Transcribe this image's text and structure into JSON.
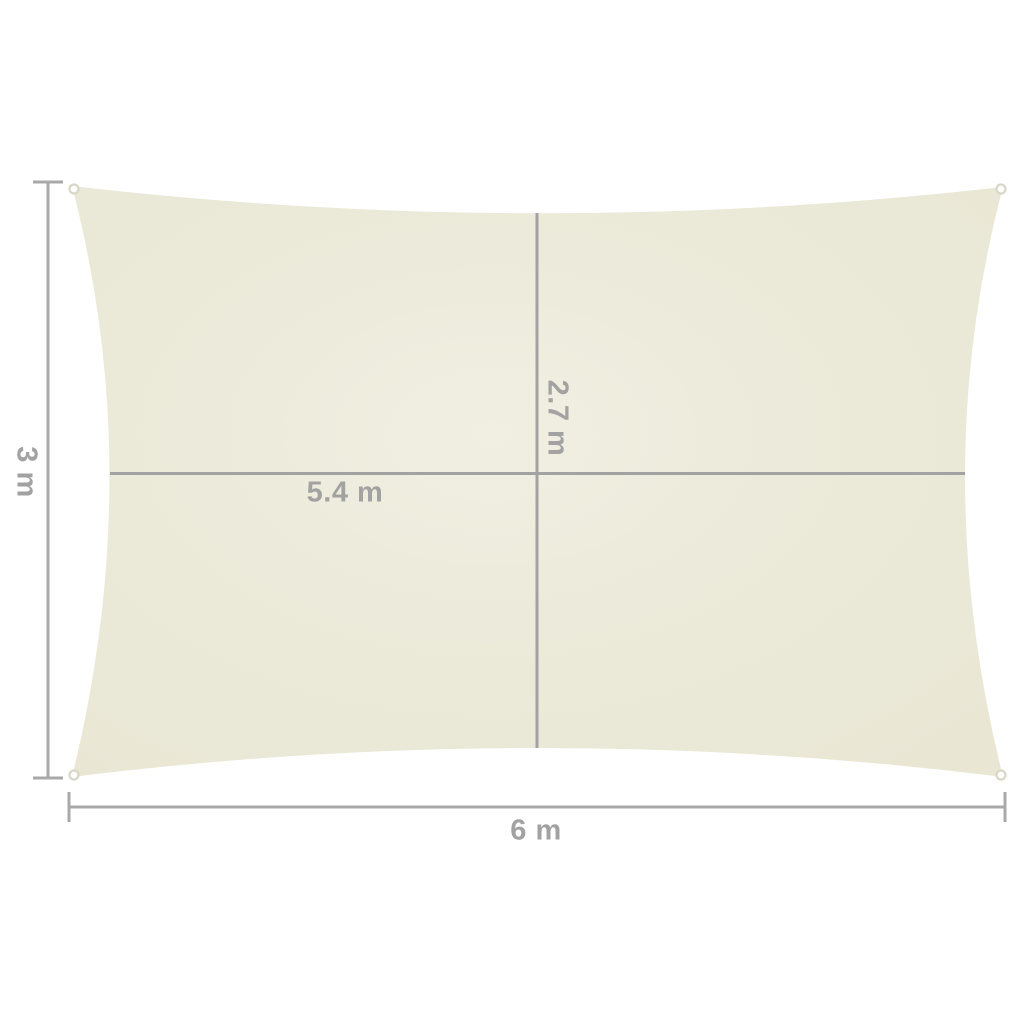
{
  "diagram": {
    "title": "Rectangular shade sail dimension diagram",
    "labels": {
      "height": "3 m",
      "width": "6 m",
      "inner_width": "5.4 m",
      "inner_height": "2.7 m"
    },
    "measurements": {
      "width_m": 6,
      "height_m": 3,
      "inner_width_m": 5.4,
      "inner_height_m": 2.7
    },
    "colors": {
      "background": "#ffffff",
      "sail_fill": "#ebe9d8",
      "sail_fill_light": "#f0efe2",
      "dimension_line": "#a9a9a9",
      "interior_line": "#a2a2a2",
      "label_text": "#a2a2a2",
      "grommet_stroke": "#d9d7c6",
      "grommet_fill": "#ffffff"
    }
  }
}
